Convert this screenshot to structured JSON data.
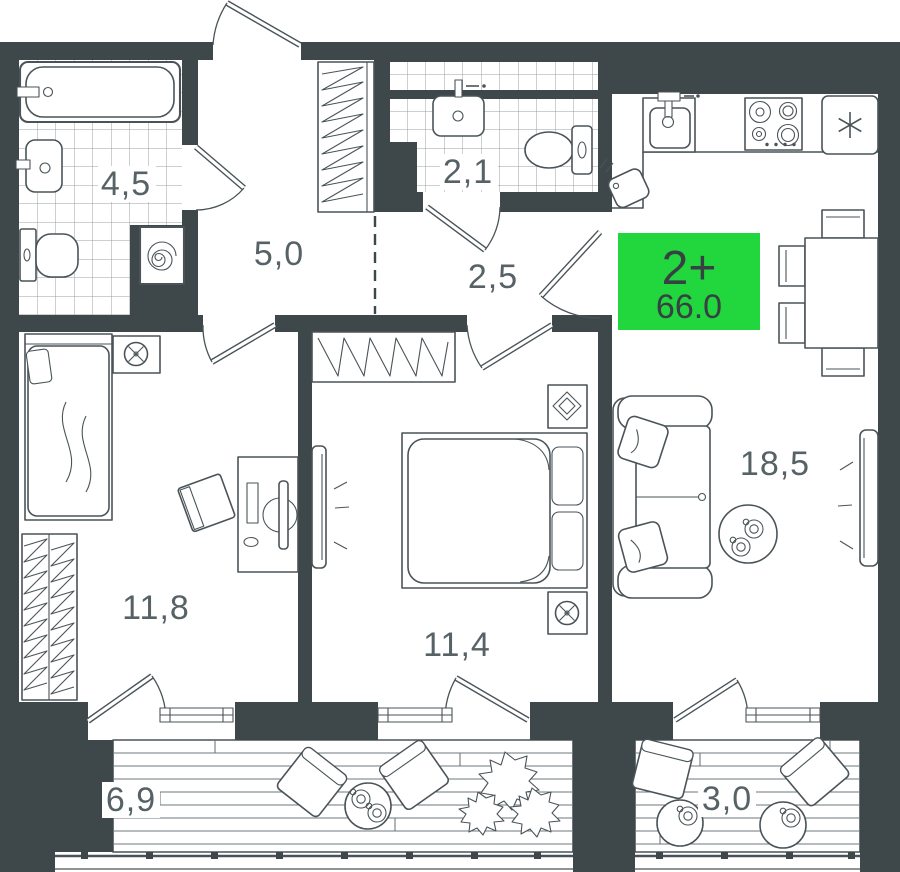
{
  "floorplan": {
    "badge": {
      "label": "2+",
      "area": "66.0"
    },
    "rooms": [
      {
        "name": "bathroom-main",
        "area": "4,5"
      },
      {
        "name": "hallway",
        "area": "5,0"
      },
      {
        "name": "wc-small",
        "area": "2,1"
      },
      {
        "name": "corridor",
        "area": "2,5"
      },
      {
        "name": "bedroom-left",
        "area": "11,8"
      },
      {
        "name": "bedroom-middle",
        "area": "11,4"
      },
      {
        "name": "living-kitchen",
        "area": "18,5"
      },
      {
        "name": "balcony-left",
        "area": "6,9"
      },
      {
        "name": "balcony-right",
        "area": "3,0"
      }
    ],
    "colors": {
      "wall": "#3e474a",
      "line": "#4a5458",
      "tile": "#9aa1a3",
      "label": "#576266",
      "deck": "#6e787b",
      "accent": "#22d63d",
      "badge_text": "#374043"
    }
  }
}
